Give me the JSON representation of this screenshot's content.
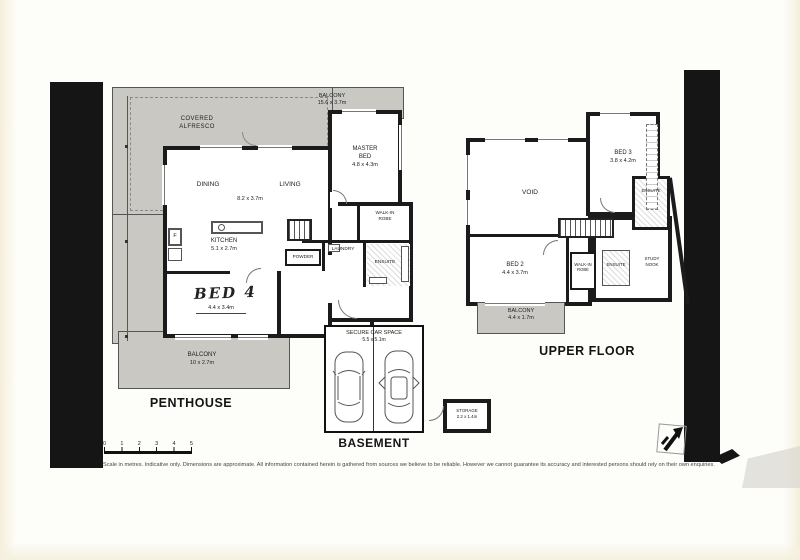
{
  "plans": {
    "penthouse": {
      "title": "PENTHOUSE",
      "balcony_top": {
        "name": "BALCONY",
        "dims": "15.6 x 3.7m"
      },
      "covered_alfresco": {
        "line1": "COVERED",
        "line2": "ALFRESCO"
      },
      "master_bed": {
        "line1": "MASTER",
        "line2": "BED",
        "dims": "4.8 x 4.3m"
      },
      "dining": "DINING",
      "living": "LIVING",
      "living_dims": "8.2 x 3.7m",
      "kitchen": {
        "name": "KITCHEN",
        "dims": "5.1 x 2.7m"
      },
      "fridge": "F",
      "walk_in_robe": {
        "line1": "WALK-IN",
        "line2": "ROBE"
      },
      "laundry": "LAUNDRY",
      "powder": "POWDER",
      "ensuite": "ENSUITE",
      "bed4": {
        "name": "BED 4",
        "dims": "4.4 x 3.4m"
      },
      "balcony_bottom": {
        "name": "BALCONY",
        "dims": "10 x 2.7m"
      }
    },
    "upper_floor": {
      "title": "UPPER FLOOR",
      "bed3": {
        "name": "BED 3",
        "dims": "3.8 x 4.2m"
      },
      "void": "VOID",
      "ensuite_bed3": "ENSUITE",
      "bed2": {
        "name": "BED 2",
        "dims": "4.4 x 3.7m"
      },
      "walk_in_robe": {
        "line1": "WALK-IN",
        "line2": "ROBE"
      },
      "ensuite_bed2": "ENSUITE",
      "study_nook": {
        "line1": "STUDY",
        "line2": "NOOK"
      },
      "balcony": {
        "name": "BALCONY",
        "dims": "4.4 x 1.7m"
      }
    },
    "basement": {
      "title": "BASEMENT",
      "car_space": {
        "name": "SECURE CAR SPACE",
        "dims": "5.5 x 5.1m"
      },
      "storage": {
        "name": "STORAGE",
        "dims": "2.2 x 1.4m"
      }
    }
  },
  "scale_bar": {
    "ticks": [
      "0",
      "1",
      "2",
      "3",
      "4",
      "5"
    ]
  },
  "disclaimer": "Scale in metres. Indicative only. Dimensions are approximate. All information contained herein is gathered from sources we believe to be reliable. However we cannot guarantee its accuracy and interested persons should rely on their own enquiries.",
  "colors": {
    "wall": "#1b1b1b",
    "balcony_fill": "#c9c8c3",
    "paper": "#fdfdfa"
  }
}
